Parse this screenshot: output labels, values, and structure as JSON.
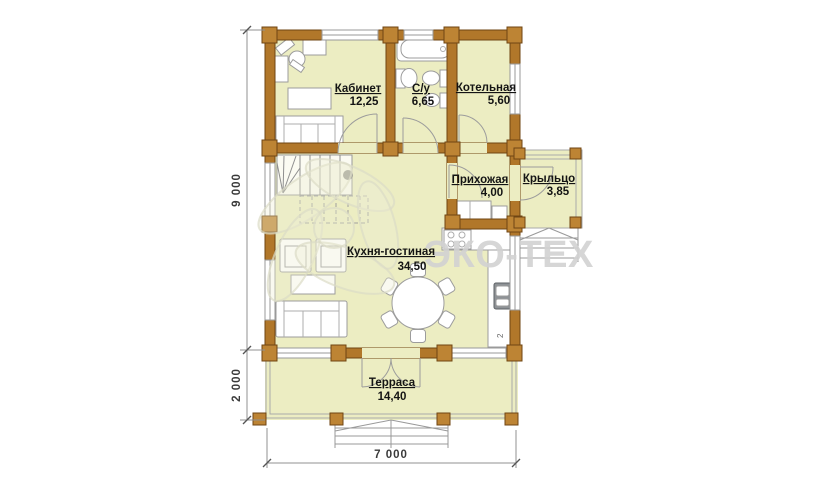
{
  "plan": {
    "rooms": {
      "kabinet": {
        "name": "Кабинет",
        "area": "12,25"
      },
      "su": {
        "name": "С/у",
        "area": "6,65"
      },
      "kotelnaya": {
        "name": "Котельная",
        "area": "5,60"
      },
      "prihozhaya": {
        "name": "Прихожая",
        "area": "4,00"
      },
      "krylco": {
        "name": "Крыльцо",
        "area": "3,85"
      },
      "kuhnya_gostinaya": {
        "name": "Кухня-гостиная",
        "area": "34,50"
      },
      "terrasa": {
        "name": "Терраса",
        "area": "14,40"
      }
    },
    "dimensions": {
      "height_main": "9 000",
      "height_terrace": "2 000",
      "width": "7 000"
    },
    "annotations": {
      "kitchen_marker": "2"
    },
    "watermark": {
      "brand": "ЭКО-ТЕХ"
    },
    "colors": {
      "wall": "#B1772A",
      "wall_outline": "#6F4513",
      "room_fill": "#ECEDC2",
      "furniture_outline": "#9C9C9C",
      "dimension": "#909090",
      "label": "#141414",
      "watermark": "#D2D2D2"
    }
  }
}
